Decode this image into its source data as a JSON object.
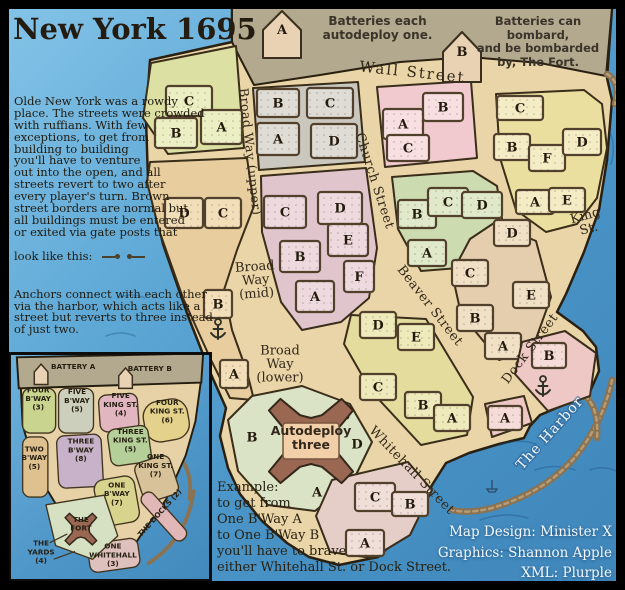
{
  "title": "New York 1695",
  "intro": {
    "p1": "Olde New York was a rowdy\nplace. The streets were crowded\nwith ruffians. With few\nexceptions, to get from\nbuilding to building\nyou'll have to venture\nout into the open, and all\nstreets revert to two after\nevery player's turn. Brown\nstreet borders are normal but\nall buildings must be entered\nor exited via gate posts that",
    "gate_line": "look like this:",
    "p2": "Anchors connect with each other\nvia the harbor, which acts like a\nstreet but reverts to three instead\nof just two.",
    "p3": "The fort is not part of its\nsurrounding territory, \"The Yards\"."
  },
  "banners": {
    "autodeploy": "Batteries each autodeploy one.",
    "bombard": "Batteries can bombard,\nand be bombarded\nby, The Fort."
  },
  "example": "Example:\nto get from\nOne B'Way A\nto One B'Way B\nyou'll have to brave\neither Whitehall St. or Dock Street.",
  "credits": "Map Design: Minister X\nGraphics: Shannon Apple\nXML: Plurple",
  "colors": {
    "water": "#4a92c6",
    "land": "#e9d5a7",
    "outside_wall": "#b3a98e",
    "outline": "#2a2012",
    "pier": "#8a7252",
    "letter": "#241b0e"
  },
  "map": {
    "land_points": "150,60 232,42 232,8 612,8 607,78 612,100 607,160 599,210 584,252 566,294 557,312 583,331 596,347 599,371 589,394 566,404 540,415 530,426 524,438 499,444 469,453 446,463 427,493 405,531 378,557 339,565 309,557 287,543 262,521 240,494 228,468 220,436 226,408 210,372 188,316 163,244 148,180 146,118",
    "gray_points": "232,8 612,8 606,76 540,63 470,57 400,62 320,75 254,85 240,58 232,42",
    "water_lines": [
      "M500,445 q18,-7 36,-1",
      "M535,470 q20,-7 40,0",
      "M480,520 q25,-9 48,-2",
      "M545,535 q20,-6 38,1",
      "M470,555 q28,-8 55,-2",
      "M590,470 q14,-5 26,1",
      "M118,298 q14,-6 27,0",
      "M106,336 q15,-6 29,0",
      "M610,132 q6,16 1,32"
    ],
    "piers": [
      "M612,380 Q603,422 576,456 Q546,492 492,508 Q468,514 452,510",
      "M585,396 Q599,408 597,438",
      "M607,74 Q621,82 615,104"
    ],
    "boats": [
      "M574,378 h13 l-3,4 h-7 z M580,367 v11 M580,367 l7,10",
      "M487,489 h10 l-2,3 h-6 z M492,480 v9"
    ],
    "batteries": [
      {
        "letter": "A",
        "points": "263,58 263,30 282,11 301,30 301,58",
        "lx": 282,
        "ly": 34
      },
      {
        "letter": "B",
        "points": "443,82 443,52 462,32 481,52 481,82",
        "lx": 462,
        "ly": 56
      }
    ],
    "fort": {
      "cx": 311,
      "cy": 441,
      "label_line1": "Autodeploy",
      "label_line2": "three"
    },
    "streets": [
      {
        "t": "Wall Street",
        "x": 412,
        "y": 77,
        "r": 6,
        "s": 15,
        "sp": 2
      },
      {
        "t": "Broad Way (upper)",
        "x": 246,
        "y": 152,
        "r": 84,
        "s": 12.5,
        "sp": 0.5
      },
      {
        "t": "Broad\nWay\n(mid)",
        "x": 256,
        "y": 284,
        "r": -4,
        "s": 13
      },
      {
        "t": "Broad\nWay\n(lower)",
        "x": 280,
        "y": 368,
        "r": 0,
        "s": 13
      },
      {
        "t": "Church Street",
        "x": 371,
        "y": 182,
        "r": 72,
        "s": 13,
        "sp": 0.5
      },
      {
        "t": "King\nSt.",
        "x": 588,
        "y": 226,
        "r": -15,
        "s": 13
      },
      {
        "t": "Beaver Street",
        "x": 427,
        "y": 308,
        "r": 52,
        "s": 13,
        "sp": 0.5
      },
      {
        "t": "Dock Street",
        "x": 533,
        "y": 351,
        "r": -53,
        "s": 13,
        "sp": 0.5
      },
      {
        "t": "Whitehall Street",
        "x": 409,
        "y": 473,
        "r": 46,
        "s": 13,
        "sp": 0.5
      },
      {
        "t": "The Harbor",
        "x": 553,
        "y": 436,
        "r": -48,
        "s": 14,
        "sp": 1,
        "c": "#f4f8fb",
        "halo": 1
      }
    ],
    "territories": [
      {
        "id": "four-bway",
        "name": "Four B'Way",
        "color": "#dce0a2",
        "block_color": "#ecefc3",
        "points": "151,63 236,46 244,148 168,154 143,118",
        "blocks": [
          {
            "letter": "C",
            "x": 166,
            "y": 86,
            "w": 46,
            "h": 30
          },
          {
            "letter": "B",
            "x": 155,
            "y": 118,
            "w": 42,
            "h": 30
          },
          {
            "letter": "A",
            "x": 201,
            "y": 110,
            "w": 41,
            "h": 34
          }
        ]
      },
      {
        "id": "five-bway",
        "name": "Five B'Way",
        "color": "#cac7be",
        "block_color": "#dedcd5",
        "points": "253,88 358,82 365,162 259,170",
        "blocks": [
          {
            "letter": "B",
            "x": 257,
            "y": 89,
            "w": 42,
            "h": 28
          },
          {
            "letter": "A",
            "x": 257,
            "y": 123,
            "w": 42,
            "h": 32
          },
          {
            "letter": "C",
            "x": 307,
            "y": 88,
            "w": 46,
            "h": 30
          },
          {
            "letter": "D",
            "x": 311,
            "y": 124,
            "w": 46,
            "h": 34
          }
        ]
      },
      {
        "id": "five-kingst",
        "name": "Five King St.",
        "color": "#f1cacf",
        "block_color": "#f8dfe2",
        "points": "377,87 471,81 477,158 385,167",
        "blocks": [
          {
            "letter": "B",
            "x": 423,
            "y": 93,
            "w": 40,
            "h": 28
          },
          {
            "letter": "A",
            "x": 383,
            "y": 109,
            "w": 40,
            "h": 30
          },
          {
            "letter": "C",
            "x": 387,
            "y": 135,
            "w": 42,
            "h": 26
          }
        ]
      },
      {
        "id": "four-kingst",
        "name": "Four King St.",
        "color": "#ebdfa0",
        "block_color": "#f4ecc5",
        "points": "496,94 584,90 602,104 607,148 597,198 577,224 546,232 516,210 500,158",
        "blocks": [
          {
            "letter": "C",
            "x": 497,
            "y": 96,
            "w": 46,
            "h": 24
          },
          {
            "letter": "B",
            "x": 494,
            "y": 134,
            "w": 36,
            "h": 26
          },
          {
            "letter": "F",
            "x": 529,
            "y": 145,
            "w": 36,
            "h": 26
          },
          {
            "letter": "D",
            "x": 563,
            "y": 129,
            "w": 38,
            "h": 26
          },
          {
            "letter": "A",
            "x": 516,
            "y": 190,
            "w": 38,
            "h": 24
          },
          {
            "letter": "E",
            "x": 549,
            "y": 188,
            "w": 36,
            "h": 24
          }
        ]
      },
      {
        "id": "two-bway",
        "name": "Two B'Way",
        "color": "#e8cd9e",
        "block_color": "#f2dfba",
        "points": "150,162 247,158 254,206 237,250 224,290 232,330 247,372 254,400 230,398 211,360 183,298 159,230 147,182",
        "blocks": [
          {
            "letter": "D",
            "x": 165,
            "y": 198,
            "w": 38,
            "h": 30
          },
          {
            "letter": "C",
            "x": 205,
            "y": 198,
            "w": 36,
            "h": 30
          },
          {
            "letter": "B",
            "x": 204,
            "y": 290,
            "w": 28,
            "h": 28
          },
          {
            "letter": "A",
            "x": 220,
            "y": 360,
            "w": 28,
            "h": 28
          }
        ],
        "anchors": [
          {
            "x": 218,
            "y": 331
          }
        ]
      },
      {
        "id": "three-bway",
        "name": "Three B'Way",
        "color": "#e1c5cd",
        "block_color": "#eedade",
        "points": "261,176 366,168 377,248 369,298 341,322 302,330 281,302 262,232",
        "blocks": [
          {
            "letter": "C",
            "x": 264,
            "y": 196,
            "w": 42,
            "h": 32
          },
          {
            "letter": "D",
            "x": 318,
            "y": 192,
            "w": 44,
            "h": 32
          },
          {
            "letter": "B",
            "x": 280,
            "y": 241,
            "w": 40,
            "h": 31
          },
          {
            "letter": "E",
            "x": 328,
            "y": 224,
            "w": 40,
            "h": 32
          },
          {
            "letter": "A",
            "x": 296,
            "y": 281,
            "w": 38,
            "h": 31
          },
          {
            "letter": "F",
            "x": 344,
            "y": 261,
            "w": 30,
            "h": 31
          }
        ]
      },
      {
        "id": "three-kingst",
        "name": "Three King St.",
        "color": "#cddbb1",
        "block_color": "#e0eaca",
        "points": "392,177 473,171 497,186 503,225 471,267 421,271 398,229",
        "blocks": [
          {
            "letter": "B",
            "x": 398,
            "y": 200,
            "w": 38,
            "h": 28
          },
          {
            "letter": "C",
            "x": 428,
            "y": 188,
            "w": 40,
            "h": 28
          },
          {
            "letter": "D",
            "x": 462,
            "y": 192,
            "w": 40,
            "h": 26
          },
          {
            "letter": "A",
            "x": 408,
            "y": 240,
            "w": 38,
            "h": 26
          }
        ]
      },
      {
        "id": "one-kingst",
        "name": "One King St.",
        "color": "#e5cead",
        "block_color": "#f0e0c5",
        "points": "494,223 536,241 551,297 532,350 499,360 461,314 452,273 470,239",
        "blocks": [
          {
            "letter": "D",
            "x": 494,
            "y": 220,
            "w": 36,
            "h": 26
          },
          {
            "letter": "C",
            "x": 452,
            "y": 260,
            "w": 36,
            "h": 26
          },
          {
            "letter": "E",
            "x": 513,
            "y": 282,
            "w": 36,
            "h": 26
          },
          {
            "letter": "B",
            "x": 457,
            "y": 305,
            "w": 36,
            "h": 26
          },
          {
            "letter": "A",
            "x": 485,
            "y": 333,
            "w": 36,
            "h": 26
          }
        ]
      },
      {
        "id": "one-bway",
        "name": "One B'Way",
        "color": "#e3dc9d",
        "block_color": "#efeabb",
        "points": "351,315 426,319 473,397 467,435 421,445 371,391 344,344",
        "blocks": [
          {
            "letter": "D",
            "x": 360,
            "y": 312,
            "w": 36,
            "h": 26
          },
          {
            "letter": "E",
            "x": 398,
            "y": 324,
            "w": 36,
            "h": 26
          },
          {
            "letter": "C",
            "x": 360,
            "y": 374,
            "w": 36,
            "h": 26
          },
          {
            "letter": "B",
            "x": 405,
            "y": 392,
            "w": 36,
            "h": 26
          },
          {
            "letter": "A",
            "x": 434,
            "y": 405,
            "w": 36,
            "h": 26
          }
        ]
      },
      {
        "id": "yards",
        "name": "The Yards",
        "color": "#dae3c5",
        "points": "228,420 252,396 302,386 350,404 372,442 353,481 315,511 268,505 238,471",
        "letters": [
          {
            "letter": "B",
            "x": 252,
            "y": 437
          },
          {
            "letter": "C",
            "x": 345,
            "y": 415
          },
          {
            "letter": "D",
            "x": 357,
            "y": 444
          },
          {
            "letter": "A",
            "x": 317,
            "y": 492
          }
        ]
      },
      {
        "id": "one-whitehall",
        "name": "One Whitehall",
        "color": "#e5cec7",
        "block_color": "#f0ded8",
        "points": "332,480 408,462 432,490 410,535 372,558 330,552 316,516",
        "blocks": [
          {
            "letter": "C",
            "x": 355,
            "y": 483,
            "w": 40,
            "h": 28
          },
          {
            "letter": "B",
            "x": 392,
            "y": 492,
            "w": 36,
            "h": 24
          },
          {
            "letter": "A",
            "x": 346,
            "y": 530,
            "w": 38,
            "h": 26
          }
        ]
      },
      {
        "id": "docks-b",
        "name": "The Docks",
        "color": "#edc8c5",
        "block_color": "#f6dcd9",
        "points": "522,342 565,331 596,353 590,396 548,411 515,374",
        "blocks": [
          {
            "letter": "B",
            "x": 532,
            "y": 343,
            "w": 34,
            "h": 25
          }
        ],
        "anchors": [
          {
            "x": 543,
            "y": 388
          }
        ]
      },
      {
        "id": "docks-a",
        "name": "The Docks",
        "color": "#edc8c5",
        "block_color": "#f6dcd9",
        "points": "485,404 524,396 532,423 492,437",
        "blocks": [
          {
            "letter": "A",
            "x": 488,
            "y": 406,
            "w": 34,
            "h": 24
          }
        ]
      }
    ]
  },
  "inset": {
    "land_points": "18,382 204,376 198,420 188,455 168,500 140,540 122,568 96,556 62,518 34,472 20,424",
    "gray_points": "14,354 206,350 204,380 16,386",
    "battery_houses": [
      "32,382 32,369 39,361 46,369 46,382",
      "119,386 119,373 126,365 133,373 133,386"
    ],
    "yards_points": "44,506 104,496 118,538 92,562 54,548",
    "fort": {
      "cx": 80,
      "cy": 531
    },
    "piers": [
      "M178,452 Q196,470 192,500",
      "M196,492 Q190,540 150,566"
    ],
    "pointer_lines": [
      [
        48,
        545,
        66,
        536
      ],
      [
        52,
        562,
        74,
        554
      ]
    ],
    "patches": [
      {
        "id": "four-bway",
        "x": 20,
        "y": 386,
        "w": 34,
        "h": 46,
        "rx": 8,
        "rot": 0,
        "color": "#c9d58e"
      },
      {
        "id": "five-bway",
        "x": 57,
        "y": 386,
        "w": 36,
        "h": 46,
        "rx": 8,
        "rot": 0,
        "color": "#cbcfbc"
      },
      {
        "id": "five-kingst",
        "x": 99,
        "y": 392,
        "w": 40,
        "h": 38,
        "rx": 8,
        "rot": -4,
        "color": "#e2b6c1"
      },
      {
        "id": "four-kingst",
        "x": 145,
        "y": 398,
        "w": 46,
        "h": 42,
        "rx": 16,
        "rot": -10,
        "color": "#e4d28c"
      },
      {
        "id": "two-bway",
        "x": 20,
        "y": 436,
        "w": 26,
        "h": 62,
        "rx": 8,
        "rot": 0,
        "color": "#dfc190"
      },
      {
        "id": "three-bway",
        "x": 56,
        "y": 434,
        "w": 46,
        "h": 54,
        "rx": 8,
        "rot": -3,
        "color": "#c7b2ca"
      },
      {
        "id": "three-kingst",
        "x": 109,
        "y": 426,
        "w": 42,
        "h": 38,
        "rx": 8,
        "rot": -8,
        "color": "#b5cf99"
      },
      {
        "id": "one-kingst",
        "x": 139,
        "y": 458,
        "w": 38,
        "h": 42,
        "rx": 8,
        "rot": -18,
        "color": "#d8c29a"
      },
      {
        "id": "one-bway",
        "x": 96,
        "y": 478,
        "w": 42,
        "h": 48,
        "rx": 10,
        "rot": -10,
        "color": "#d8d38d"
      },
      {
        "id": "docks",
        "x": 158,
        "y": 487,
        "w": 15,
        "h": 62,
        "rx": 7,
        "rot": -42,
        "color": "#e2b7b7"
      },
      {
        "id": "one-whitehall",
        "x": 88,
        "y": 543,
        "w": 52,
        "h": 30,
        "rx": 8,
        "rot": -8,
        "color": "#dec0bc"
      }
    ],
    "labels": [
      {
        "t": "BATTERY A",
        "x": 72,
        "y": 366
      },
      {
        "t": "BATTERY B",
        "x": 151,
        "y": 368
      },
      {
        "t": "FOUR\nB'WAY\n(3)",
        "x": 36,
        "y": 399
      },
      {
        "t": "FIVE\nB'WAY\n(5)",
        "x": 76,
        "y": 401
      },
      {
        "t": "FIVE\nKING ST.\n(4)",
        "x": 121,
        "y": 405
      },
      {
        "t": "FOUR\nKING ST.\n(6)",
        "x": 169,
        "y": 412
      },
      {
        "t": "TWO\nB'WAY\n(5)",
        "x": 32,
        "y": 460
      },
      {
        "t": "THREE\nB'WAY\n(8)",
        "x": 80,
        "y": 452
      },
      {
        "t": "THREE\nKING ST.\n(5)",
        "x": 131,
        "y": 442
      },
      {
        "t": "ONE\nKING ST.\n(7)",
        "x": 157,
        "y": 468
      },
      {
        "t": "ONE\nB'WAY\n(7)",
        "x": 117,
        "y": 497
      },
      {
        "t": "THE DOCKS (2)",
        "x": 163,
        "y": 516,
        "r": -48
      },
      {
        "t": "THE\nFORT",
        "x": 80,
        "y": 528
      },
      {
        "t": "THE\nYARDS\n(4)",
        "x": 39,
        "y": 557
      },
      {
        "t": "ONE\nWHITEHALL\n(3)",
        "x": 113,
        "y": 560
      }
    ]
  }
}
